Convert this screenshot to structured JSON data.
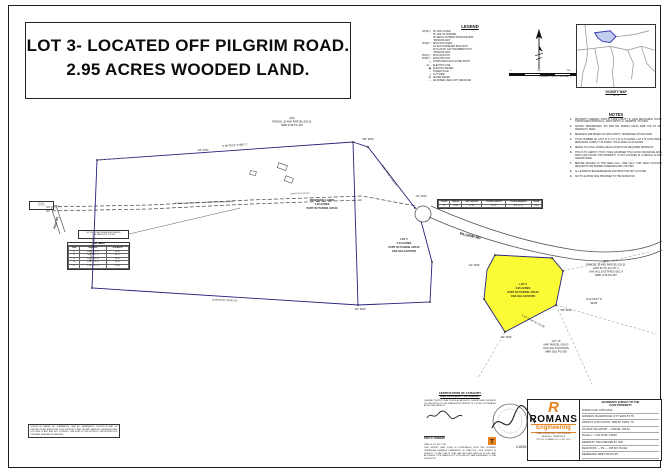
{
  "title": {
    "line1": "LOT 3- LOCATED OFF PILGRIM ROAD.",
    "line2": "2.95 ACRES WOODED LAND."
  },
  "legend": {
    "heading": "LEGEND",
    "items": [
      {
        "sym": "IPF(S) =",
        "text": "PK NAIL FOUND"
      },
      {
        "sym": "",
        "text": "PK NAIL W/ WASHER"
      },
      {
        "sym": "",
        "text": "W/ METAL WITNESS DISTANCE MKR."
      },
      {
        "sym": "",
        "text": "\"ROMANS 2119\""
      },
      {
        "sym": "IPS(S) =",
        "text": "IRON ROD (NEW)"
      },
      {
        "sym": "",
        "text": "1/2 INCH DIAMETER IRON ROD"
      },
      {
        "sym": "",
        "text": "W/ PLASTIC CAP INSCRIBED WITH"
      },
      {
        "sym": "",
        "text": "\"ROMANS 2119\""
      },
      {
        "sym": "IPF(O) =",
        "text": "IRON ROD OLD"
      },
      {
        "sym": "IPS(O) =",
        "text": "IRON PIPE OLD"
      },
      {
        "sym": "△",
        "text": "COMPUTED/CALCULATED POINT"
      },
      {
        "sym": "—E—",
        "text": "ELECTRIC LINE"
      },
      {
        "sym": "▣",
        "text": "ELECTRIC METER"
      },
      {
        "sym": "○",
        "text": "POWER POLE"
      },
      {
        "sym": "↘",
        "text": "GUY WIRE"
      },
      {
        "sym": "Ⓦ",
        "text": "WATER METER"
      },
      {
        "sym": "- - -",
        "text": "ADJOINER LINES NOT SURVEYED"
      }
    ]
  },
  "scale_bar": {
    "ticks": [
      "0",
      "100",
      "200",
      "300"
    ],
    "caption": "( SCALE: 1 INCH = 100 FEET )"
  },
  "vicinity": {
    "caption1": "VICINITY MAP",
    "caption2": "N.T.S."
  },
  "notes": {
    "heading": "NOTES",
    "items": [
      "PROPERTY OWNERS: JOHN W. CAVE & BETTY B. CAVE REVOCABLE TRUST, STATESVIEW FARM MILLS, 10067 SMITH LN., MEMPHIS, TN 37203.",
      "SURVEY REFERENCES: TAX MAP 091, PARCEL 026.00, MRB 1746 PG 387, WARRANTY DEED.",
      "BEARINGS ARE BASED ON GRID NORTH, TENNESSEE STATE PLANE.",
      "TOTAL NUMBER OF LOTS IS 3: LOT 2 IS ±2.15 ACRES, LOT 3 IS ±2.95 ACRES, REMAINING LANDS ±7.36 ACRES. TOTAL AREA ±12.46 ACRES.",
      "REFER TO LOCAL ZONING REGULATIONS FOR REQUIRED SETBACKS.",
      "THIS IS TO CERTIFY THAT I HAVE EXAMINED THE FLOOD INSURANCE RATE MAPS AND FOUND THIS PROPERTY IS NOT LOCATED IN A SPECIAL FLOOD HAZARD ZONE.",
      "BEFORE DIGGING IN THIS AREA CALL \"ONE CALL\" FOR FIELD LOCATION REQUESTS FOR BURIED UNDERGROUND UTILITIES.",
      "ALL EVIDENT FENCES/REMAINS AND IRON PINS NOT LOCATED.",
      "NO TITLE WORK WAS PROVIDED TO THE SURVEYOR."
    ]
  },
  "pob": {
    "line1": "P.O.B.",
    "line2": "LOT 3"
  },
  "callout": {
    "line1": "50' EXISTING INGRESS/EGRESS",
    "line2": "PER MRB 1811 PG 500"
  },
  "line_table": {
    "title": "LINE TABLE",
    "cols": [
      "LINE",
      "BEARING",
      "DISTANCE"
    ],
    "rows": [
      [
        "L1",
        "N 86°14'32\" E",
        "50.00'"
      ],
      [
        "L2",
        "N 84°02'11\" E",
        "48.12'"
      ],
      [
        "L3",
        "N 87°55'40\" E",
        "52.30'"
      ],
      [
        "L4",
        "S 88°21'05\" E",
        "49.75'"
      ],
      [
        "L5",
        "S 86°47'22\" E",
        "51.08'"
      ]
    ]
  },
  "curve_table": {
    "cols": [
      "CURVE",
      "RADIUS",
      "ARC LENGTH",
      "CHORD LENGTH",
      "CHORD BEARING",
      "DELTA"
    ],
    "rows": [
      [
        "C1",
        "50.00'",
        "62.83'",
        "58.12'",
        "N 47°12' E",
        "72°00'"
      ]
    ]
  },
  "certification": {
    "heading1": "CERTIFICATION OF CATEGORY",
    "heading2": "AND ACCURACY OF SURVEY",
    "body1": "I HEREBY CERTIFY THAT THIS IS A CATEGORY I SURVEY AND THE RATIO OF PRECISION OF THE UNADJUSTED SURVEY IS 1:10,000 OR GREATER AS SHOWN HEREON.",
    "signer": "TROY E. ROMANS",
    "reg": "TENN. R.L.S. NO. 2119",
    "body2": "THIS SURVEY WAS DONE IN COMPLIANCE WITH THE CURRENT TENNESSEE MINIMUM STANDARDS OF PRACTICE. THIS SURVEY IS SUBJECT TO ANY FACTS THAT MAY BE DISCLOSED BY A FULL AND ACCURATE TITLE SEARCH. NO TITLE REPORT WAS FURNISHED TO THE SURVEYOR."
  },
  "disclaimer": {
    "text": "SURVEYOR MAKES NO GUARANTEE THAT ALL EASEMENTS, RIGHTS-OF-WAY OR RESTRICTIONS AFFECTING THIS PROPERTY ARE SHOWN HEREON. UNDERGROUND UTILITIES, IF ANY, ARE NOT LOCATED. THIS PLAT IS VOID WITHOUT THE SURVEYOR'S ORIGINAL SEAL AND SIGNATURE."
  },
  "titleblock": {
    "header1": "BOUNDARY SURVEY OF THE",
    "header2": "CAVE PROPERTY",
    "rows": [
      "SURVEY FOR: JOHN CAVE",
      "ADDRESS: PILGRIM ROAD   CITY: EADS   ST: TN",
      "DISTRICT: 11TH   COUNTY: SHELBY   STATE: TN",
      "TAX MAP: 091   GROUP: —   PARCEL: 026.00",
      "SCALE: 1\" = 100'   DATE: 1/18/25",
      "DRAWN BY: TER   CHECKED BY: TER",
      "FIELD BOOK: —  PG: —  JOB NO: 25-0112",
      "REFERENCE: MRB 1746 PG 387"
    ],
    "firm": {
      "logo_letter": "R",
      "name": "ROMANS",
      "sub": "Engineering",
      "lines": [
        "LAND SURVEYING • CIVIL DESIGN",
        "MEMPHIS, TENNESSEE",
        "TROY E. ROMANS, R.L.S. NO. 2119"
      ]
    }
  },
  "map": {
    "lot3_fill": "#fafa35",
    "boundary_color": "#22227f",
    "labels": [
      {
        "t": "(R3)",
        "x": 292,
        "y": 119
      },
      {
        "t": "PARCEL 25 AND PARCEL 026.01",
        "x": 292,
        "y": 122.5
      },
      {
        "t": "MRB 1746 PG 387",
        "x": 292,
        "y": 126
      },
      {
        "t": "N 88°02'54\" E  588.71'",
        "x": 235,
        "y": 146,
        "r": -4
      },
      {
        "t": "1/2\" ROD",
        "x": 203,
        "y": 151
      },
      {
        "t": "5/8\" ROD",
        "x": 368,
        "y": 140
      },
      {
        "t": "S 31°40'51\" E  382.04'",
        "x": 389,
        "y": 176,
        "r": 54
      },
      {
        "t": "1/2\" ROD",
        "x": 421,
        "y": 197
      },
      {
        "t": "N 88°07'54\" E  212.35'",
        "x": 300,
        "y": 194,
        "r": -2,
        "s": 2
      },
      {
        "t": "REMAINING LANDS",
        "x": 322,
        "y": 201,
        "b": 1
      },
      {
        "t": "7.36 ACRES",
        "x": 322,
        "y": 205,
        "b": 1
      },
      {
        "t": "PART OF PARCEL 026.00",
        "x": 322,
        "y": 209,
        "b": 1
      },
      {
        "t": "LOT 2",
        "x": 404,
        "y": 240,
        "b": 1
      },
      {
        "t": "2.15 ACRES",
        "x": 404,
        "y": 244,
        "b": 1
      },
      {
        "t": "PART OF PARCEL 026.00",
        "x": 404,
        "y": 248,
        "b": 1
      },
      {
        "t": "OAK HILLS ESTATE",
        "x": 404,
        "y": 252,
        "b": 1
      },
      {
        "t": "LOT 3",
        "x": 523,
        "y": 285,
        "b": 1
      },
      {
        "t": "2.95 ACRES",
        "x": 523,
        "y": 289,
        "b": 1
      },
      {
        "t": "PART OF PARCEL 026.00",
        "x": 523,
        "y": 293,
        "b": 1
      },
      {
        "t": "OAK HILLS ESTATE",
        "x": 523,
        "y": 297,
        "b": 1
      },
      {
        "t": "PILGRIM RD",
        "x": 470,
        "y": 237,
        "r": 13,
        "b": 1,
        "s": 3.6
      },
      {
        "t": "PEW RD",
        "x": 57,
        "y": 223,
        "r": -75,
        "s": 3.1,
        "b": 1
      },
      {
        "t": "EXISTING GRAVEL DRIVE — 50' INGRESS/EGRESS EASEMENT",
        "x": 205,
        "y": 203,
        "r": -2,
        "s": 2
      },
      {
        "t": "(R4)",
        "x": 606,
        "y": 262
      },
      {
        "t": "PARCEL 26 AND PARCEL 026.01",
        "x": 606,
        "y": 265.5
      },
      {
        "t": "MAP 91 PG 23 LOT 4",
        "x": 606,
        "y": 269
      },
      {
        "t": "OAK HILLS ESTATES SEC A",
        "x": 606,
        "y": 272.5
      },
      {
        "t": "MRB 1746 PG 387",
        "x": 606,
        "y": 276
      },
      {
        "t": "S 01°52'47\" E",
        "x": 594,
        "y": 300
      },
      {
        "t": "98.28'",
        "x": 594,
        "y": 304
      },
      {
        "t": "1/2\" ROD",
        "x": 474,
        "y": 266
      },
      {
        "t": "5/8\" ROD",
        "x": 566,
        "y": 311
      },
      {
        "t": "1/2\" ROD",
        "x": 506,
        "y": 338
      },
      {
        "t": "S 67°26'18\" W  175.09'",
        "x": 533,
        "y": 322,
        "r": 27
      },
      {
        "t": "LOT 10",
        "x": 556,
        "y": 342
      },
      {
        "t": "MAP PARCEL 026.02",
        "x": 556,
        "y": 345.5
      },
      {
        "t": "OAK HILLS ESTATES",
        "x": 556,
        "y": 349
      },
      {
        "t": "MRB 1811 PG 500",
        "x": 556,
        "y": 352.5
      },
      {
        "t": "S 88°51'09\" W  542.61'",
        "x": 225,
        "y": 301,
        "r": 2
      },
      {
        "t": "N 03°25'47\" W  128.40'",
        "x": 93,
        "y": 248,
        "r": -83
      },
      {
        "t": "1/2\" ROD",
        "x": 360,
        "y": 310
      },
      {
        "t": "1/18/25",
        "x": 521,
        "y": 448,
        "s": 3.2
      }
    ]
  }
}
